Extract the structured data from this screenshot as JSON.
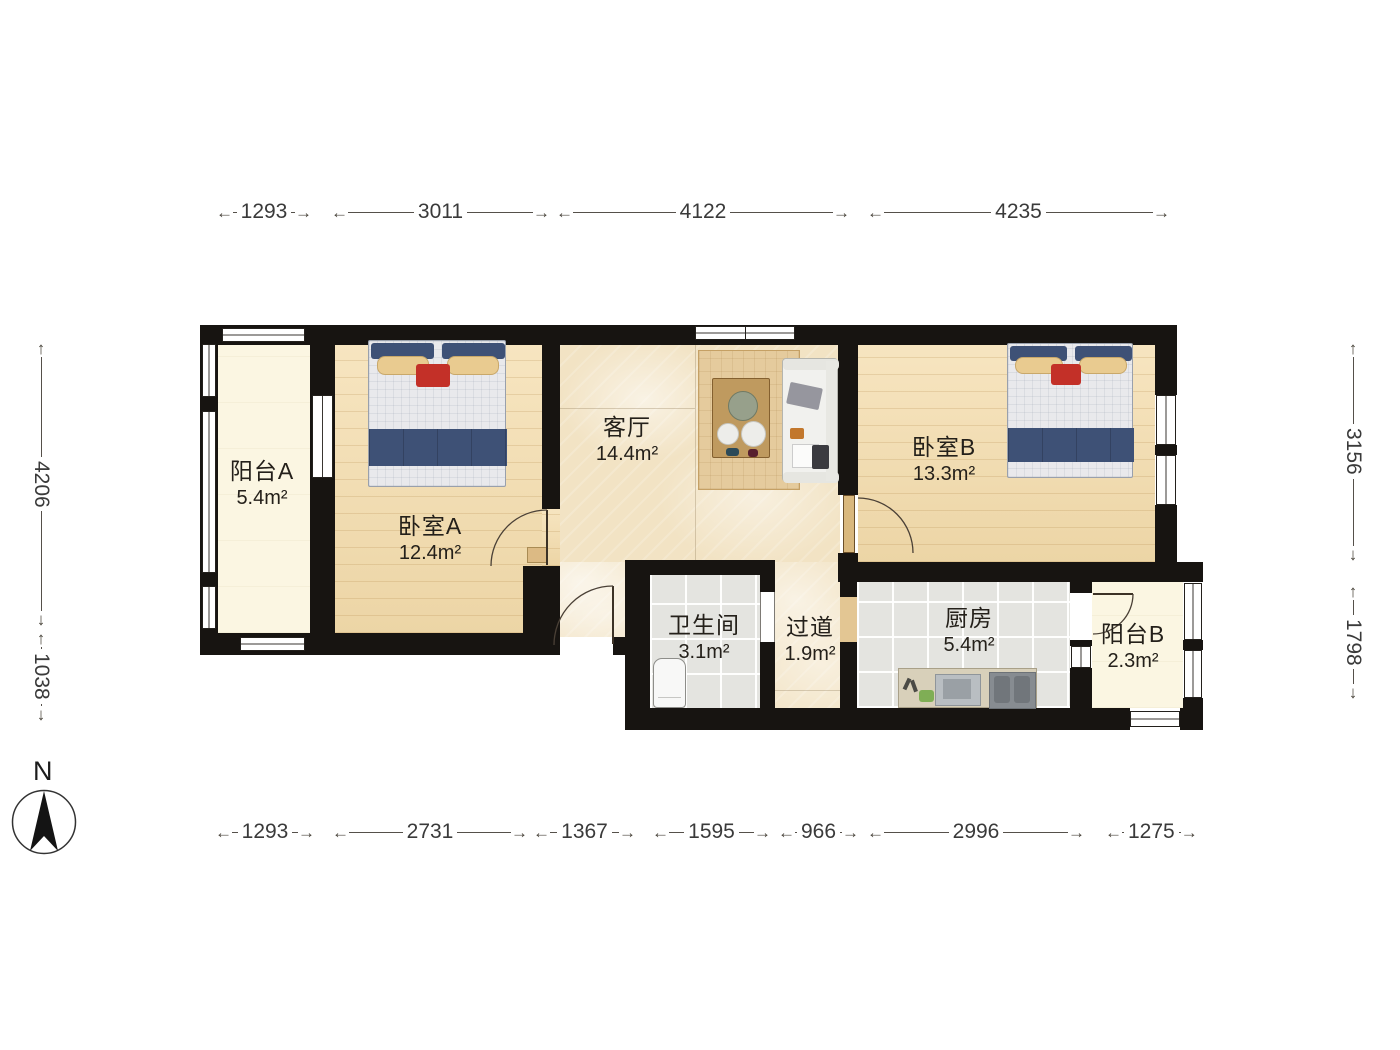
{
  "rooms": {
    "balcony_a": {
      "name": "阳台A",
      "area": "5.4m²"
    },
    "bedroom_a": {
      "name": "卧室A",
      "area": "12.4m²"
    },
    "living": {
      "name": "客厅",
      "area": "14.4m²"
    },
    "bedroom_b": {
      "name": "卧室B",
      "area": "13.3m²"
    },
    "bath": {
      "name": "卫生间",
      "area": "3.1m²"
    },
    "hall": {
      "name": "过道",
      "area": "1.9m²"
    },
    "kitchen": {
      "name": "厨房",
      "area": "5.4m²"
    },
    "balcony_b": {
      "name": "阳台B",
      "area": "2.3m²"
    }
  },
  "dimensions": {
    "top": [
      "1293",
      "3011",
      "4122",
      "4235"
    ],
    "bottom": [
      "1293",
      "2731",
      "1367",
      "1595",
      "966",
      "2996",
      "1275"
    ],
    "left": [
      "4206",
      "1038"
    ],
    "right": [
      "3156",
      "1798"
    ]
  },
  "compass": {
    "label": "N"
  },
  "colors": {
    "wall": "#171411",
    "wood_floor": "#f4dcab",
    "marble_floor": "#f2e3c4",
    "tile_floor": "#e4e4e0",
    "balcony_floor": "#fbf6e2",
    "bed_blanket": "#3e5176",
    "accent_red": "#c33028"
  }
}
